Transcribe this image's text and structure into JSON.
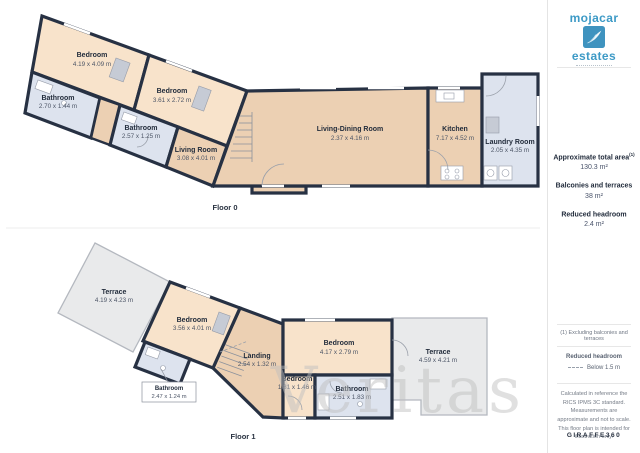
{
  "branding": {
    "name_top": "mojacar",
    "name_bottom": "estates"
  },
  "sidebar": {
    "stats": [
      {
        "label": "Approximate total area",
        "sup": "(1)",
        "value": "130.3 m²"
      },
      {
        "label": "Balconies and terraces",
        "sup": "",
        "value": "38 m²"
      },
      {
        "label": "Reduced headroom",
        "sup": "",
        "value": "2.4 m²"
      }
    ],
    "footnote": "(1) Excluding balconies and terraces",
    "legend": {
      "title": "Reduced headroom",
      "label": "Below 1.5 m"
    },
    "disclaimer": "Calculated in reference the RICS IPMS 3C standard. Measurements are approximate and not to scale. This floor plan is intended for illustration only.",
    "brand": "GIRAFFE360"
  },
  "floors": [
    {
      "label": "Floor 0",
      "rooms": [
        {
          "name": "Bedroom",
          "dims": "4.19 x 4.09 m"
        },
        {
          "name": "Bathroom",
          "dims": "2.70 x 1.44 m"
        },
        {
          "name": "Bedroom",
          "dims": "3.61 x 2.72 m"
        },
        {
          "name": "Bathroom",
          "dims": "2.57 x 1.25 m"
        },
        {
          "name": "Living Room",
          "dims": "3.08 x 4.01 m"
        },
        {
          "name": "Living-Dining Room",
          "dims": "2.37 x 4.16 m"
        },
        {
          "name": "Kitchen",
          "dims": "7.17 x 4.52 m"
        },
        {
          "name": "Laundry Room",
          "dims": "2.05 x 4.35 m"
        }
      ]
    },
    {
      "label": "Floor 1",
      "rooms": [
        {
          "name": "Terrace",
          "dims": "4.19 x 4.23 m"
        },
        {
          "name": "Bedroom",
          "dims": "3.56 x 4.01 m"
        },
        {
          "name": "Bathroom",
          "dims": "2.47 x 1.24 m"
        },
        {
          "name": "Landing",
          "dims": "2.54 x 1.32 m"
        },
        {
          "name": "Bedroom",
          "dims": "1.81 x 1.46 m"
        },
        {
          "name": "Bedroom",
          "dims": "4.17 x 2.79 m"
        },
        {
          "name": "Bathroom",
          "dims": "2.51 x 1.83 m"
        },
        {
          "name": "Terrace",
          "dims": "4.59 x 4.21 m"
        }
      ]
    }
  ],
  "watermark": "Veritas"
}
